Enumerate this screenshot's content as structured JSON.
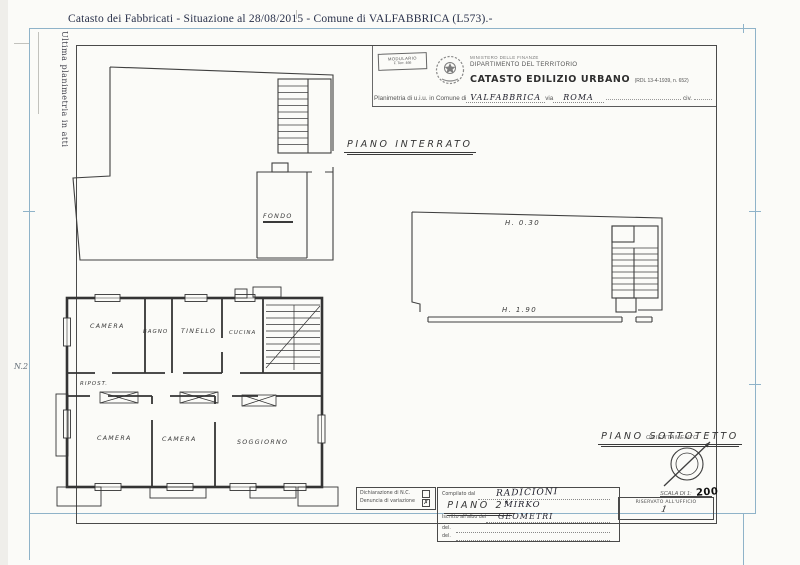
{
  "page": {
    "top_title": "Catasto dei Fabbricati - Situazione al 28/08/2015 - Comune di VALFABBRICA (L573).-",
    "side_note": "Ultima planimetria in atti",
    "margin_note": "N.2"
  },
  "header": {
    "modulario": [
      "MODULARIO",
      "F. Terr. 466"
    ],
    "ministry_line1": "MINISTERO DELLE FINANZE",
    "ministry_line2": "DIPARTIMENTO DEL TERRITORIO",
    "catasto_title": "CATASTO EDILIZIO URBANO",
    "catasto_suffix": "(RDL 13-4-1939, n. 652)",
    "planimetria_label": "Planimetria di u.i.u. in Comune di",
    "comune_value": "VALFABBRICA",
    "via_label": "via",
    "via_value": "ROMA",
    "civ_label": "civ."
  },
  "plans": {
    "interrato": {
      "title": "PIANO INTERRATO",
      "rooms": [
        "FONDO"
      ]
    },
    "piano2": {
      "title": "PIANO 2°",
      "rooms": [
        "CAMERA",
        "BAGNO",
        "TINELLO",
        "CUCINA",
        "RIPOST.",
        "CAMERA",
        "CAMERA",
        "SOGGIORNO"
      ]
    },
    "sottotetto": {
      "title": "PIANO SOTTOTETTO",
      "annotations": [
        "H. 0.30",
        "H. 1.90"
      ]
    }
  },
  "footer": {
    "orientamento_label": "ORIENTAMENTO",
    "scala_label": "SCALA DI 1:",
    "scala_value": "200",
    "dichiarazione_label": "Dichiarazione di N.C.",
    "denuncia_label": "Denuncia di variazione",
    "nc_mark": "",
    "variazione_mark": "✗",
    "compilato_label": "Compilato dal",
    "compilato_value": "RADICIONI",
    "nome_value": "MIRKO",
    "iscritto_label": "Iscritto all'albo dei",
    "albo_value": "GEOMETRI",
    "del_label1": "del.",
    "del_label2": "del.",
    "riservato_label": "RISERVATO ALL'UFFICIO",
    "riservato_mark": "1"
  }
}
